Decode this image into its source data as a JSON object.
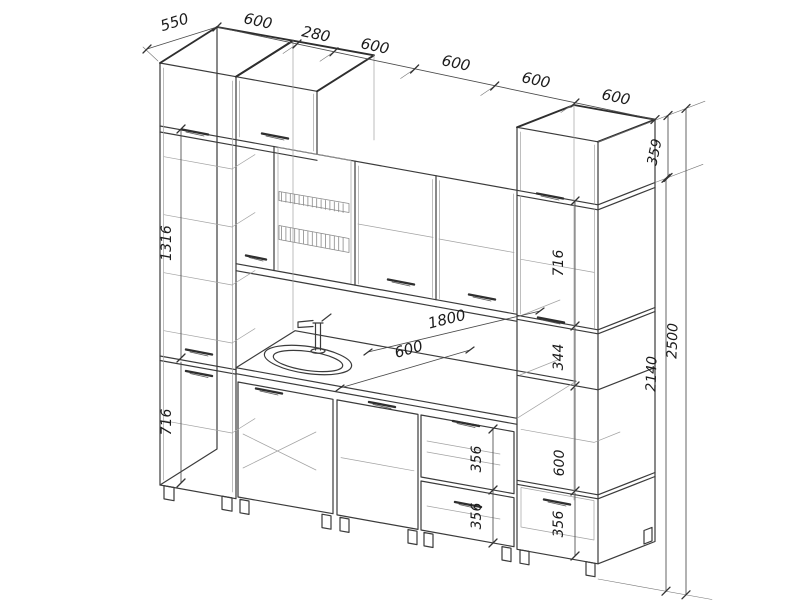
{
  "drawing": {
    "kind": "kitchen cabinet set - dimensioned technical drawing",
    "background_color": "#ffffff",
    "line_color": "#3b3b3b",
    "dimension_color": "#4a4a4a",
    "labels": {
      "tall_left_depth": "550",
      "width_1": "600",
      "width_2": "280",
      "width_3": "600",
      "width_4": "600",
      "width_5": "600",
      "width_6": "600",
      "right_top_box_height": "359",
      "total_height": "2500",
      "wall_top_height": "2140",
      "left_upper_section": "1316",
      "left_lower_section": "716",
      "right_wall_cabinet": "716",
      "right_shelf_gap": "344",
      "right_open_section": "600",
      "right_bottom_drawer": "356",
      "base_drawer_upper": "356",
      "base_drawer_lower": "356",
      "countertop_length": "1800",
      "countertop_depth": "600"
    }
  }
}
